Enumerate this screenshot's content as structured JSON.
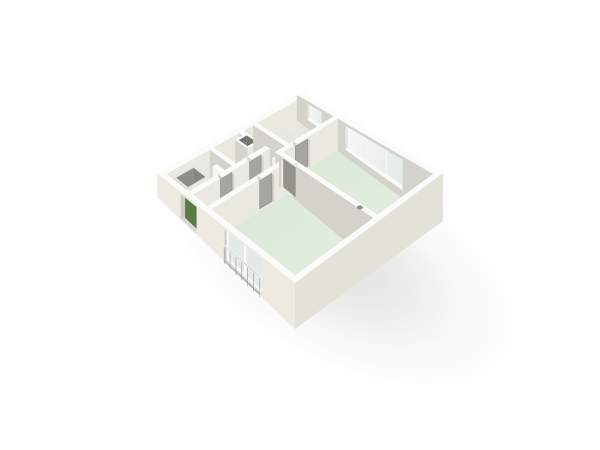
{
  "scene": {
    "kind": "floorplan-3d-isometric-render",
    "background": "#ffffff",
    "camera": "elevated-view-from-south",
    "colors": {
      "wall_top": "#fbfbfa",
      "wall_outer_sw": "#eceae1",
      "wall_outer_se": "#e3e2d9",
      "wall_inner_light": "#e9e8e1",
      "wall_inner_dark": "#d3d3cc",
      "wall_inner_faint": "#f3f2ec",
      "wall_inner_lit": "#f1f0ea",
      "floor_base": "#e8e8e3",
      "floor_gray": "#e0e0db",
      "floor_toproom": "#e4e8e1",
      "floor_green": "#d9e7d5",
      "floor_green_light": "#e8f0e4",
      "shaft_dark": "#73736d",
      "shaft_floor": "#63635e",
      "door_leaf": "#a6a6a0",
      "door_leaf_dark": "#93938c",
      "door_edge": "#8b8b84",
      "front_door_green": "#5a7b44",
      "front_door_edge": "#4a6937",
      "glass": "#e3eae7",
      "glass_top": "#f6f8f6",
      "glass_frosted": "#e4e9e6",
      "frame_white": "#f8f8f5",
      "railing": "#a3a39d",
      "railing_rail": "#d8d8d2",
      "shower_outer": "#c6c6c0",
      "shower_inner": "#8e8e88",
      "shower_inner2": "#868680",
      "shower_floor": "#9a9a94",
      "shower_rim": "#e6e6e1",
      "radiator": "#f4f4f0",
      "radiator_side": "#e8e8e3",
      "recess_jamb": "#c9c9c2",
      "threshold": "#d8d8d3",
      "floor_object": "#8d8d87",
      "shadow": "#8c8c85"
    },
    "rooms": [
      {
        "name": "living-room",
        "floor": "pale-green",
        "position": "east"
      },
      {
        "name": "bedroom",
        "floor": "pale-green",
        "position": "south-west"
      },
      {
        "name": "top-room",
        "floor": "light-green-gray",
        "position": "north"
      },
      {
        "name": "bathroom",
        "floor": "light-gray",
        "position": "west",
        "fixtures": [
          "shower-enclosure",
          "radiator"
        ]
      },
      {
        "name": "toilet-room",
        "floor": "light-gray",
        "position": "north-center"
      },
      {
        "name": "hallway",
        "floor": "off-white",
        "position": "center"
      }
    ],
    "features": [
      {
        "name": "front-door",
        "type": "exterior-door",
        "color": "green",
        "wall": "southwest"
      },
      {
        "name": "balcony-window",
        "type": "glass-sliding-door",
        "panels": 2,
        "wall": "southwest"
      },
      {
        "name": "balcony-railing",
        "type": "french-balcony",
        "balusters": 7
      },
      {
        "name": "living-room-window",
        "type": "window",
        "panes": 3,
        "wall": "northeast"
      },
      {
        "name": "top-room-window",
        "type": "window",
        "panes": 1,
        "wall": "northeast"
      },
      {
        "name": "bathroom-door",
        "type": "interior-door"
      },
      {
        "name": "toilet-door",
        "type": "interior-door"
      },
      {
        "name": "bedroom-door",
        "type": "interior-door"
      },
      {
        "name": "living-room-door",
        "type": "interior-door"
      },
      {
        "name": "top-room-door",
        "type": "interior-door"
      },
      {
        "name": "duct-shaft",
        "type": "shaft"
      },
      {
        "name": "shower-enclosure",
        "type": "fixture"
      },
      {
        "name": "radiator-1",
        "type": "fixture"
      },
      {
        "name": "radiator-2",
        "type": "fixture"
      },
      {
        "name": "floor-object",
        "type": "small-object"
      },
      {
        "name": "drop-shadow",
        "type": "soft-shadow",
        "direction": "south-east"
      }
    ]
  }
}
